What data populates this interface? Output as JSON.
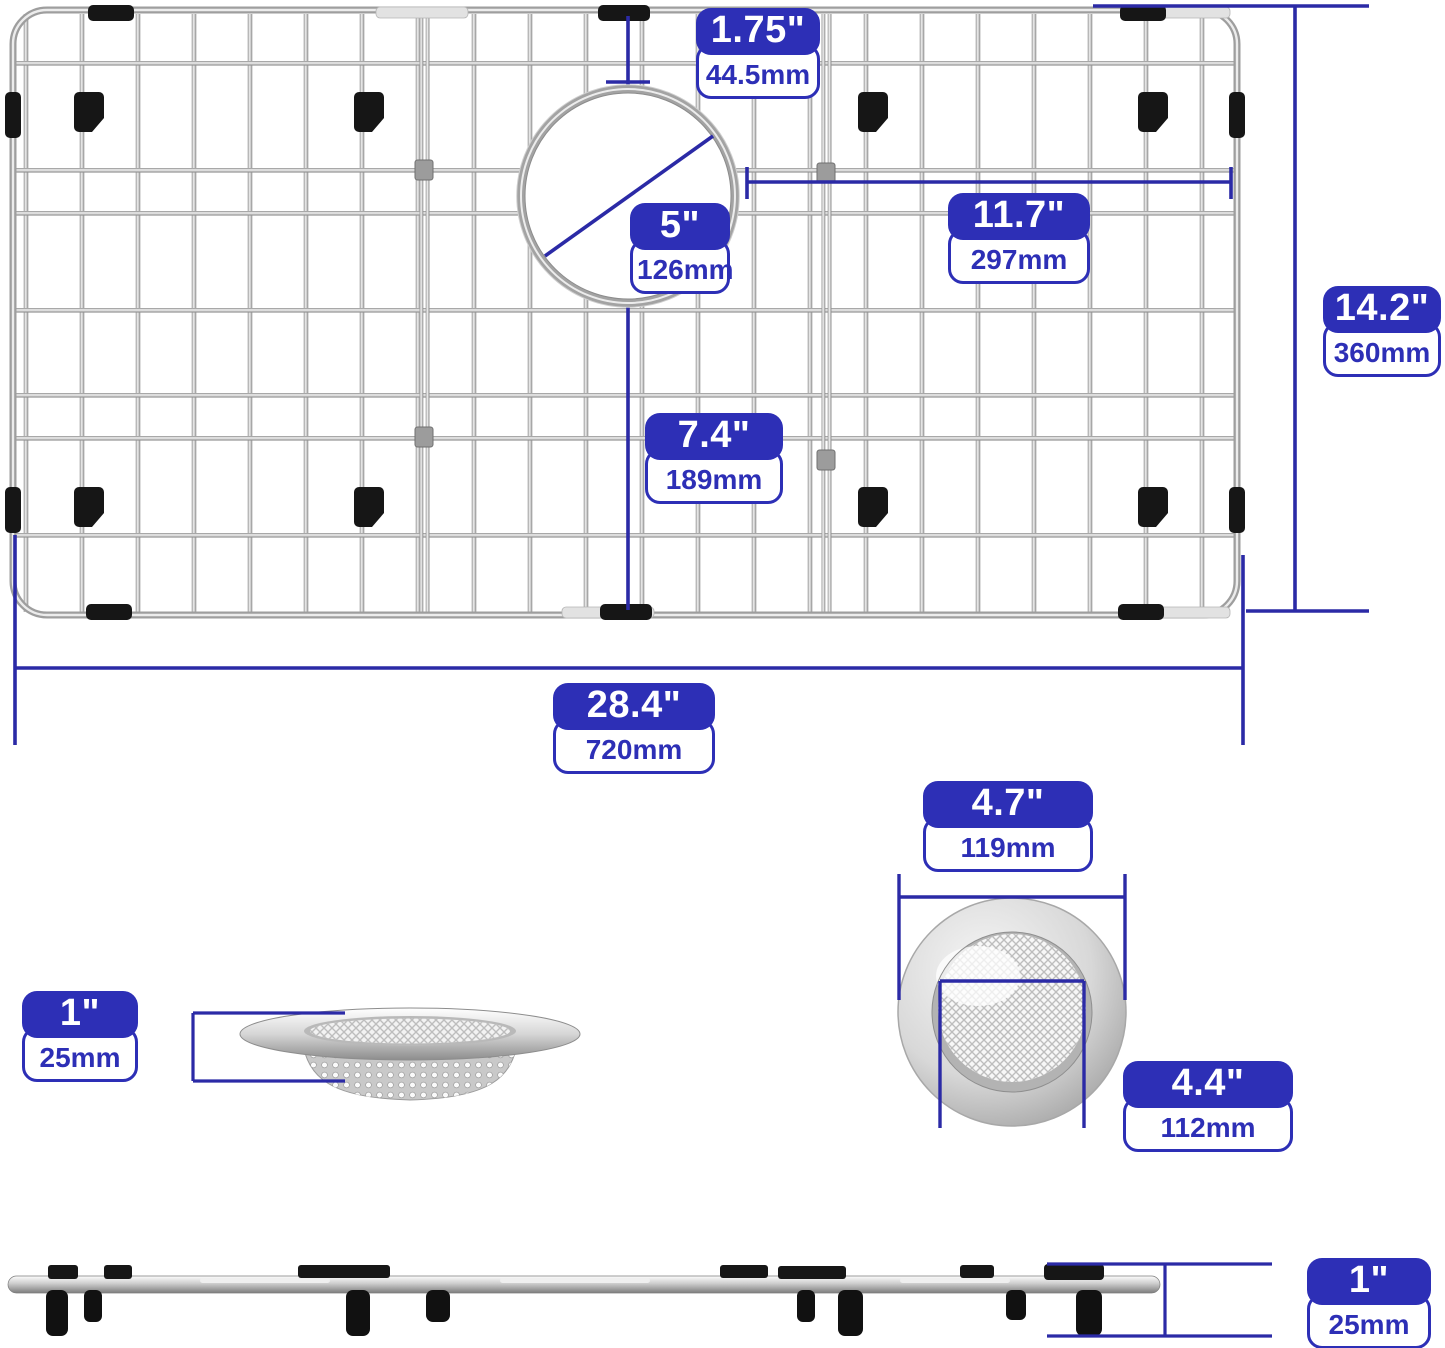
{
  "colors": {
    "accent_blue": "#2d2fb6",
    "dimension_line_blue": "#2b2aa6",
    "metal_silver": "#c0c0c0",
    "rubber_black": "#161616"
  },
  "labels": {
    "drain_offset_top": {
      "inches": "1.75\"",
      "mm": "44.5mm"
    },
    "drain_diameter": {
      "inches": "5\"",
      "mm": "126mm"
    },
    "drain_to_right_edge": {
      "inches": "11.7\"",
      "mm": "297mm"
    },
    "grid_depth": {
      "inches": "14.2\"",
      "mm": "360mm"
    },
    "drain_to_bottom_edge": {
      "inches": "7.4\"",
      "mm": "189mm"
    },
    "grid_width": {
      "inches": "28.4\"",
      "mm": "720mm"
    },
    "strainer_height": {
      "inches": "1\"",
      "mm": "25mm"
    },
    "strainer_outer_diameter": {
      "inches": "4.7\"",
      "mm": "119mm"
    },
    "strainer_inner_diameter": {
      "inches": "4.4\"",
      "mm": "112mm"
    },
    "grid_profile_height": {
      "inches": "1\"",
      "mm": "25mm"
    }
  }
}
